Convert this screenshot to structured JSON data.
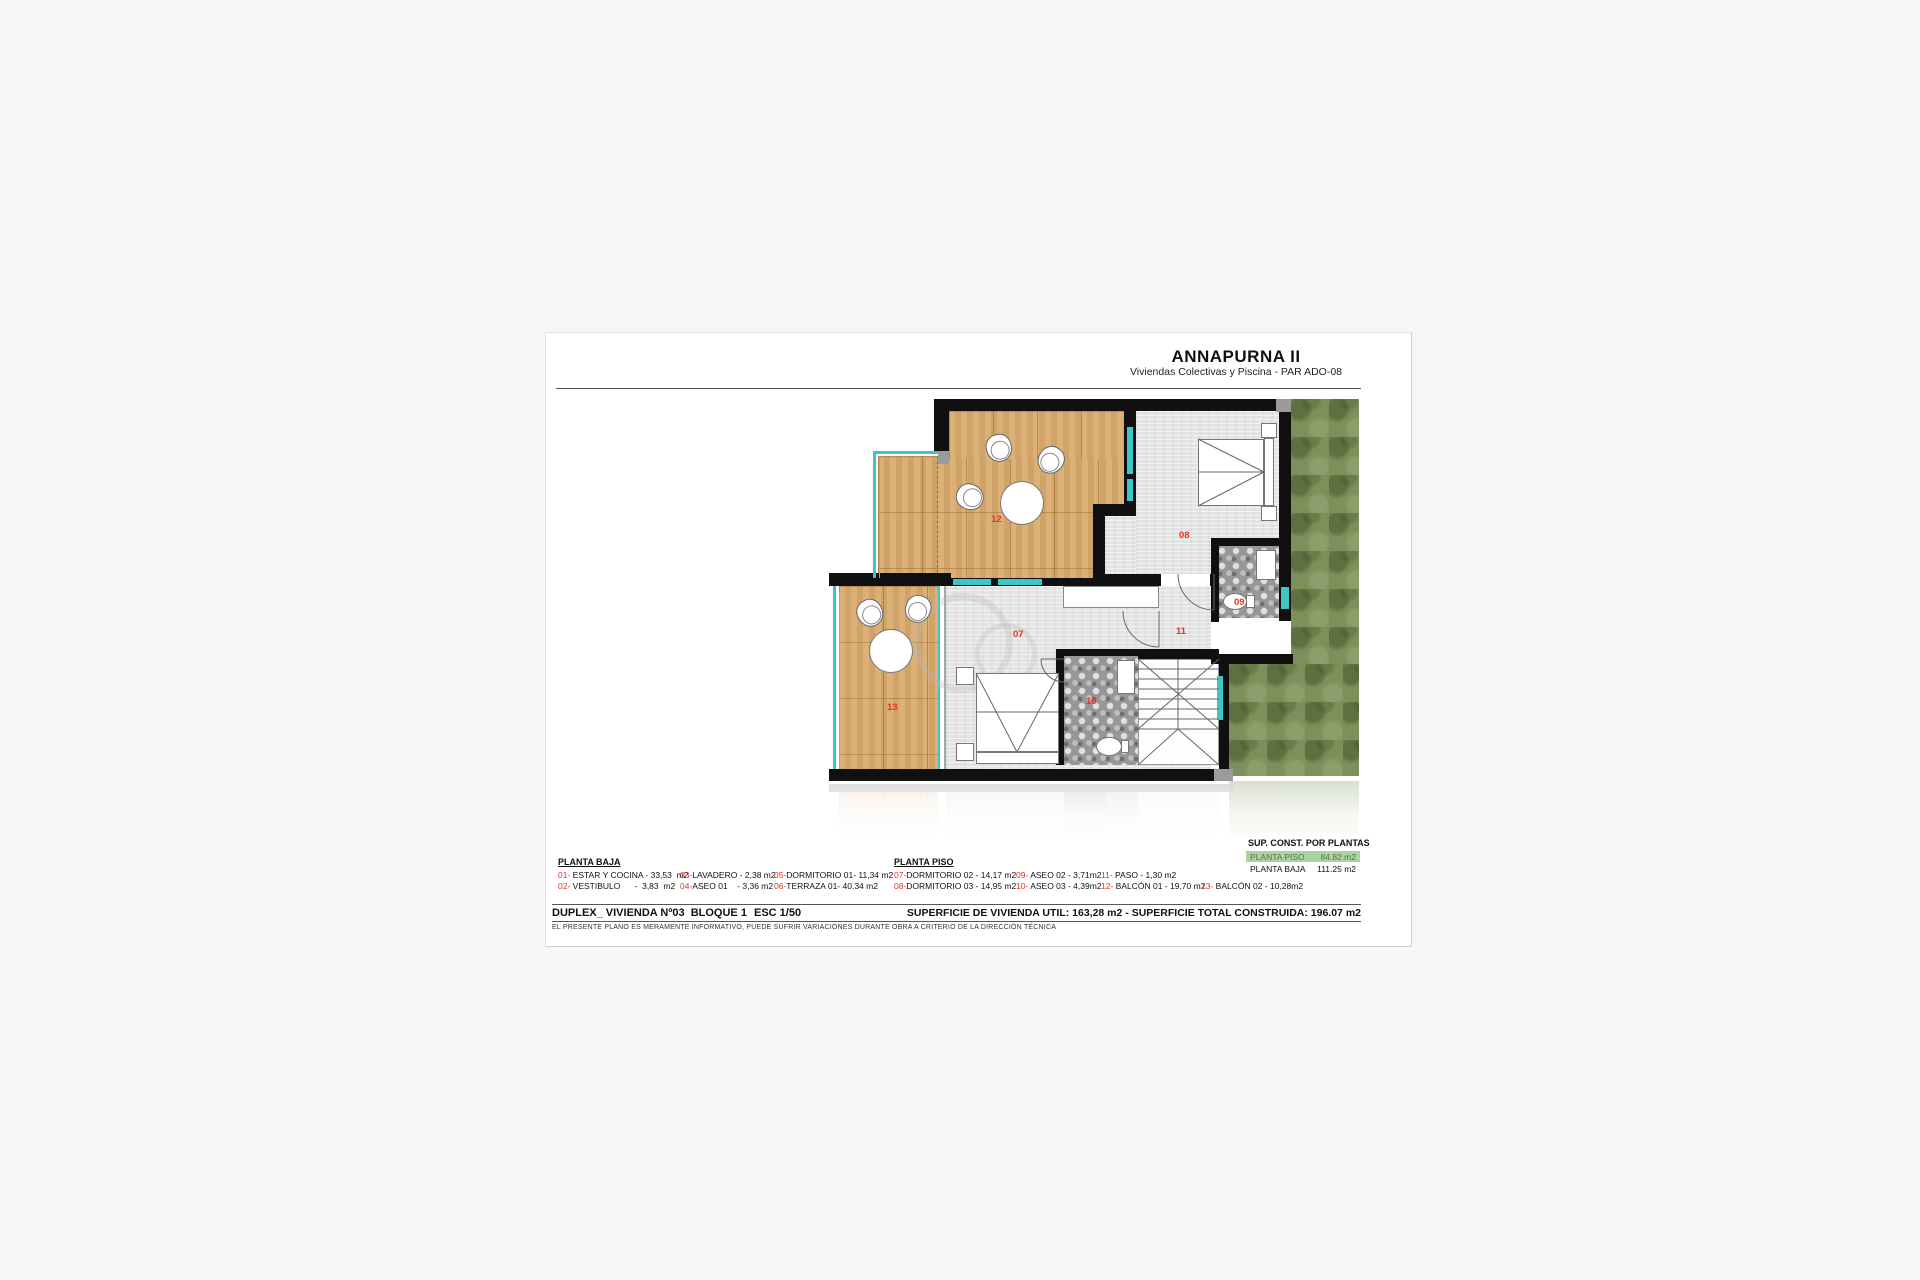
{
  "header": {
    "title": "ANNAPURNA II",
    "subtitle": "Viviendas Colectivas y Piscina - PAR ADO-08"
  },
  "legend_baja": {
    "header": "PLANTA BAJA",
    "items": [
      {
        "n": "01-",
        "t": " ESTAR Y COCINA - 33,53  m2"
      },
      {
        "n": "02-",
        "t": " VESTIBULO      -  3,83  m2"
      },
      {
        "n": "03-",
        "t": "LAVADERO - 2,38 m2"
      },
      {
        "n": "04-",
        "t": "ASEO 01    - 3,36 m2"
      },
      {
        "n": "05-",
        "t": "DORMITORIO 01- 11,34 m2"
      },
      {
        "n": "06-",
        "t": "TERRAZA 01- 40.34 m2"
      }
    ]
  },
  "legend_piso": {
    "header": "PLANTA PISO",
    "items": [
      {
        "n": "07-",
        "t": "DORMITORIO 02 - 14,17 m2"
      },
      {
        "n": "08-",
        "t": "DORMITORIO 03 - 14,95 m2"
      },
      {
        "n": "09-",
        "t": " ASEO 02 - 3,71m2"
      },
      {
        "n": "10-",
        "t": " ASEO 03 - 4,39m2"
      },
      {
        "n": "11-",
        "t": " PASO - 1,30 m2"
      },
      {
        "n": "12-",
        "t": " BALCÓN 01 - 19,70 m2"
      },
      {
        "n": "13-",
        "t": " BALCÓN 02 - 10,28m2"
      }
    ]
  },
  "sup_table": {
    "header": "SUP. CONST. POR PLANTAS",
    "rows": [
      {
        "label": "PLANTA PISO",
        "value": "84.82 m2"
      },
      {
        "label": "PLANTA BAJA",
        "value": "111.25 m2"
      }
    ]
  },
  "footer": {
    "project": "DUPLEX_ VIVIENDA Nº03  BLOQUE 1",
    "scale": "ESC 1/50",
    "superficie": "SUPERFICIE DE VIVIENDA UTIL: 163,28 m2 - SUPERFICIE TOTAL CONSTRUIDA: 196.07 m2",
    "disclaimer": "EL PRESENTE PLANO ES MERAMENTE INFORMATIVO, PUEDE SUFRIR VARIACIONES DURANTE OBRA A CRITERIO DE LA DIRECCIÓN TÉCNICA"
  },
  "plan": {
    "labels": [
      "12",
      "08",
      "07",
      "11",
      "09",
      "10",
      "13"
    ]
  },
  "colors": {
    "wall": "#101010",
    "wood": "#d9aa6d",
    "floor": "#e4e4e4",
    "tile": "#979797",
    "garden": "#7d8f5a",
    "window_teal": "#3ec6c6",
    "label_red": "#e23428",
    "highlight_green": "#abd3a0"
  }
}
